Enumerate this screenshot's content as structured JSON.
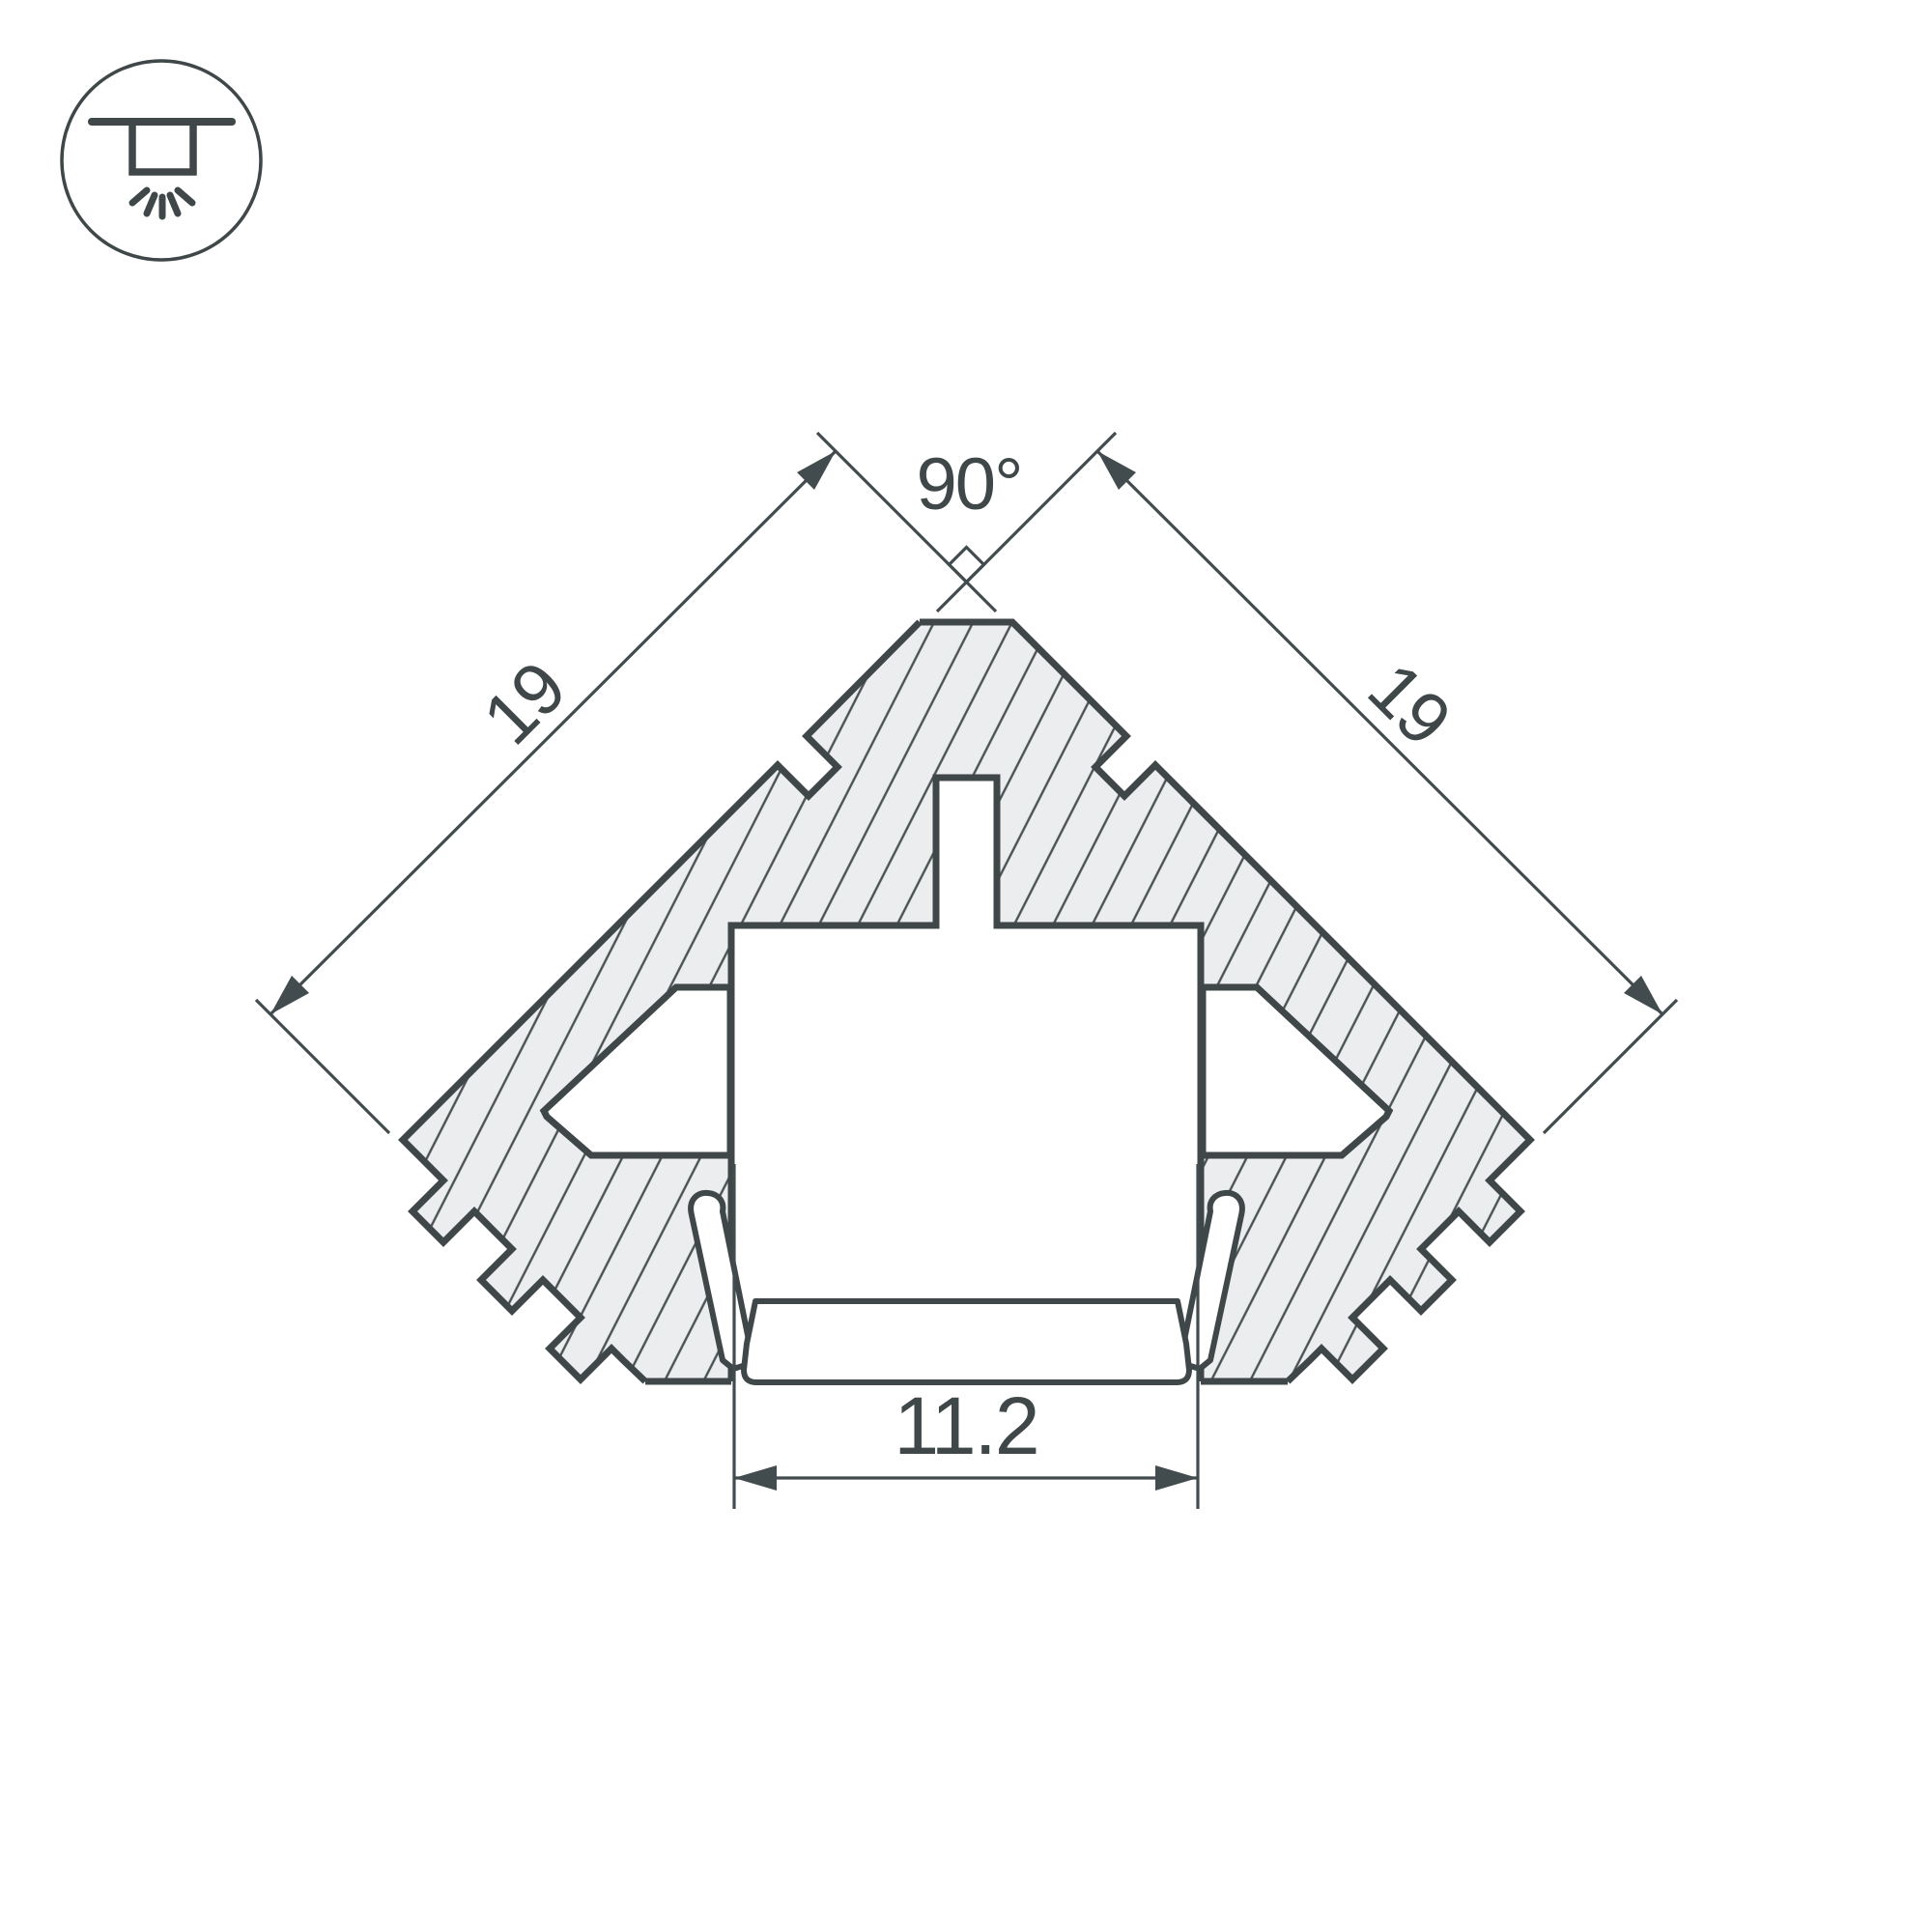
{
  "header": {
    "mount_icon": "recessed-ceiling-light-icon"
  },
  "drawing": {
    "labels": {
      "angle": "90°",
      "side_left": "19",
      "side_right": "19",
      "opening_width": "11.2"
    },
    "colors": {
      "line": "#3f4749",
      "thin_line": "#424b4e",
      "hatch_fill": "#ecedee",
      "hatch_line": "#4a5254",
      "background": "#ffffff"
    }
  }
}
